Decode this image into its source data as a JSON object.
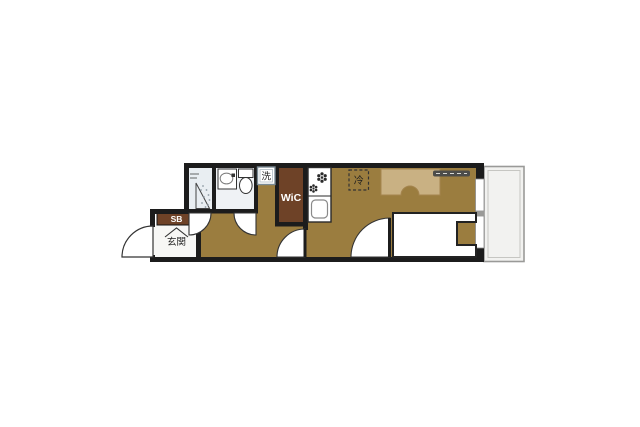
{
  "colors": {
    "wall": "#1c1c1c",
    "floor": "#9b7d3f",
    "closet_brown": "#6e4227",
    "bathroom_floor": "#e9eef2",
    "toilet_floor": "#eff2f5",
    "genkan_floor": "#f7f7f5",
    "balcony_floor": "#f2f2f0",
    "desk_tan": "#c9b183",
    "bed_white": "#ffffff",
    "fixture_white": "#ffffff",
    "label_dark": "#1f1f1f",
    "label_light": "#ffffff"
  },
  "labels": {
    "genkan": "玄関",
    "shoe_box": "SB",
    "walk_in_closet": "WiC",
    "laundry": "洗",
    "refrigerator": "冷"
  }
}
